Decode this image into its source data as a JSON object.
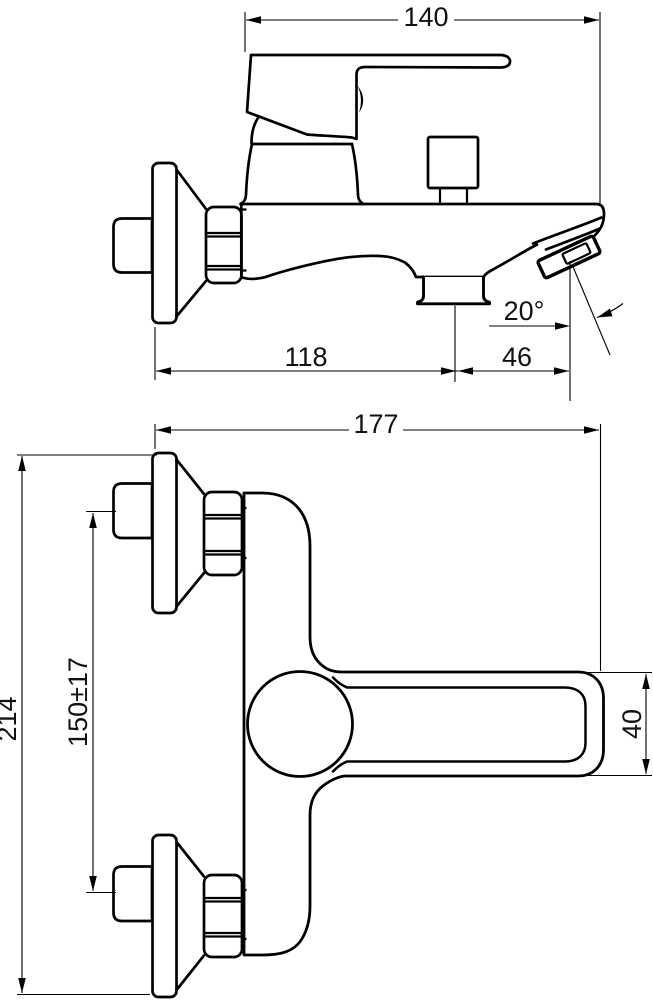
{
  "drawing": {
    "kind": "two-view technical dimension drawing",
    "subject": "wall-mounted bath mixer tap",
    "background": "#ffffff",
    "line_color": "#000000"
  },
  "dims": {
    "d140": "140",
    "d118": "118",
    "d46": "46",
    "angle20": "20°",
    "d177": "177",
    "d214": "214",
    "d150": "150±17",
    "d40": "40"
  }
}
